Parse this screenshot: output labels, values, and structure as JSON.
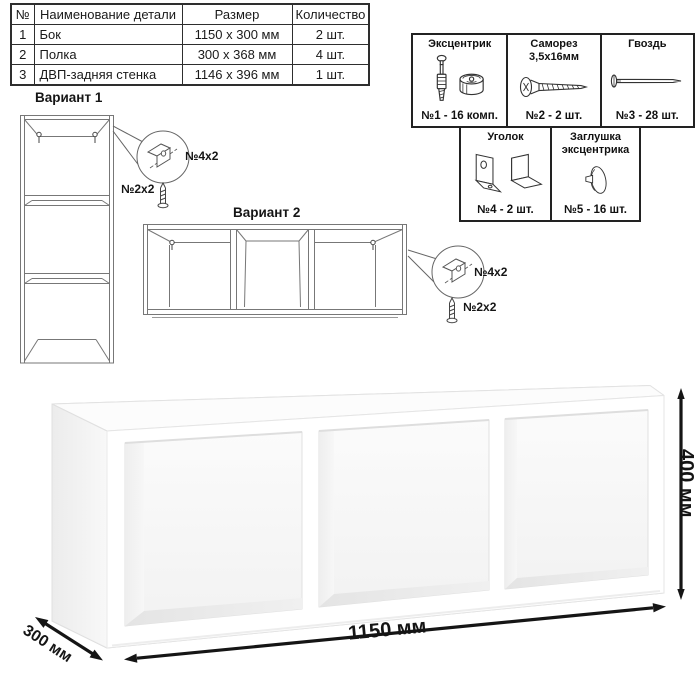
{
  "parts_table": {
    "headers": [
      "№",
      "Наименование детали",
      "Размер",
      "Количество"
    ],
    "rows": [
      {
        "num": "1",
        "name": "Бок",
        "size": "1150 х 300 мм",
        "qty": "2 шт."
      },
      {
        "num": "2",
        "name": "Полка",
        "size": "300 х 368 мм",
        "qty": "4 шт."
      },
      {
        "num": "3",
        "name": "ДВП-задняя стенка",
        "size": "1146 х 396 мм",
        "qty": "1 шт."
      }
    ]
  },
  "hardware_box": {
    "items": [
      {
        "title": "Эксцентрик",
        "subtitle": "",
        "count": "№1 - 16 комп."
      },
      {
        "title": "Саморез",
        "subtitle": "3,5х16мм",
        "count": "№2 - 2 шт."
      },
      {
        "title": "Гвоздь",
        "subtitle": "",
        "count": "№3 - 28 шт."
      },
      {
        "title": "Уголок",
        "subtitle": "",
        "count": "№4 - 2 шт."
      },
      {
        "title": "Заглушка",
        "subtitle": "эксцентрика",
        "count": "№5 - 16 шт."
      }
    ]
  },
  "variants": {
    "variant1": {
      "title": "Вариант 1",
      "bracket_label": "№4х2",
      "screw_label": "№2х2"
    },
    "variant2": {
      "title": "Вариант 2",
      "bracket_label": "№4х2",
      "screw_label": "№2х2"
    }
  },
  "dimensions": {
    "width": "1150 мм",
    "depth": "300 мм",
    "height": "400 мм"
  },
  "colors": {
    "line": "#2e2e2e",
    "drawing_line": "#777777",
    "arrow": "#151515",
    "shade": "#ededed"
  }
}
